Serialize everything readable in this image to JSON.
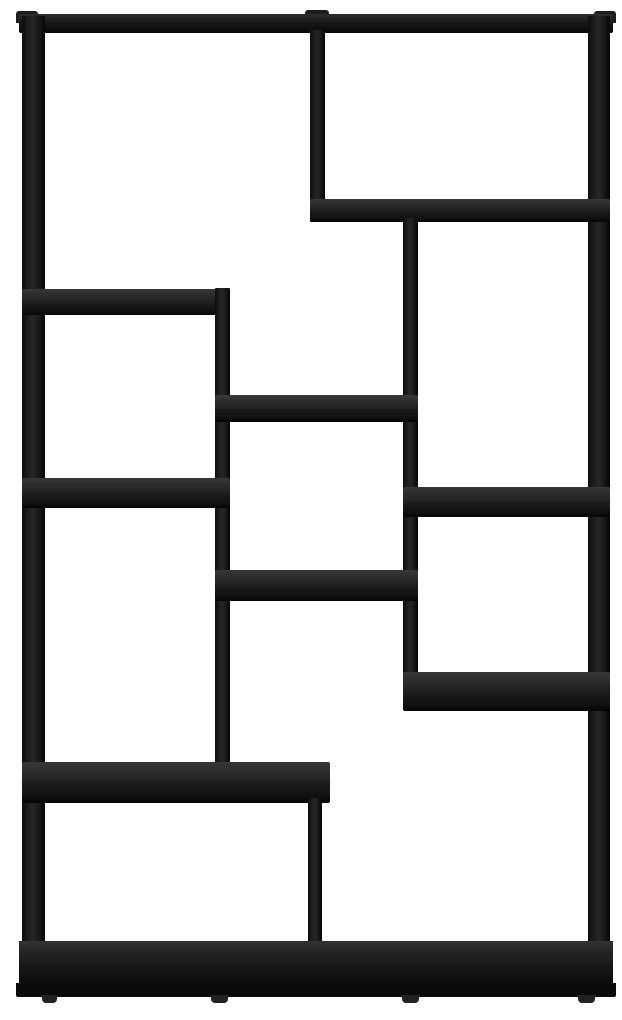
{
  "scene": {
    "description": "product photo of a black asymmetric cube bookshelf on a white background",
    "background_color": "#ffffff",
    "canvas": {
      "width": 622,
      "height": 1020
    },
    "colors": {
      "wood_top_surface": "#2e2e2e",
      "wood_front_face": "#1a1a1a",
      "wood_edge_dark": "#050505",
      "foot": "#222222"
    }
  },
  "members": [
    {
      "name": "top-corner-cap-left",
      "kind": "cap",
      "x": 16,
      "y": 11,
      "w": 22,
      "h": 12
    },
    {
      "name": "top-corner-cap-middle",
      "kind": "cap",
      "x": 305,
      "y": 10,
      "w": 24,
      "h": 12
    },
    {
      "name": "top-corner-cap-right",
      "kind": "cap",
      "x": 594,
      "y": 11,
      "w": 22,
      "h": 12
    },
    {
      "name": "top-frame-bar",
      "kind": "topbar",
      "x": 19,
      "y": 14,
      "w": 594,
      "h": 19
    },
    {
      "name": "left-side-panel",
      "kind": "panel",
      "x": 22,
      "y": 16,
      "w": 23,
      "h": 944
    },
    {
      "name": "right-side-panel",
      "kind": "panel",
      "x": 588,
      "y": 16,
      "w": 22,
      "h": 944
    },
    {
      "name": "divider-top",
      "kind": "panel",
      "x": 310,
      "y": 30,
      "w": 15,
      "h": 192
    },
    {
      "name": "shelf-top-right",
      "kind": "shelf",
      "x": 310,
      "y": 199,
      "w": 300,
      "h": 23
    },
    {
      "name": "divider-upper-middle",
      "kind": "panel",
      "x": 403,
      "y": 218,
      "w": 15,
      "h": 458
    },
    {
      "name": "shelf-upper-left",
      "kind": "shelf",
      "x": 22,
      "y": 289,
      "w": 208,
      "h": 26
    },
    {
      "name": "divider-left-middle",
      "kind": "panel",
      "x": 215,
      "y": 288,
      "w": 15,
      "h": 514
    },
    {
      "name": "shelf-middle-upper",
      "kind": "shelf",
      "x": 215,
      "y": 395,
      "w": 203,
      "h": 27
    },
    {
      "name": "shelf-left-lower",
      "kind": "shelf",
      "x": 22,
      "y": 478,
      "w": 208,
      "h": 30
    },
    {
      "name": "shelf-right-middle",
      "kind": "shelf",
      "x": 403,
      "y": 487,
      "w": 207,
      "h": 30
    },
    {
      "name": "shelf-middle-lower",
      "kind": "shelf",
      "x": 215,
      "y": 570,
      "w": 203,
      "h": 31
    },
    {
      "name": "shelf-right-lower",
      "kind": "shelf",
      "x": 403,
      "y": 672,
      "w": 207,
      "h": 39
    },
    {
      "name": "shelf-bottom-left-wide",
      "kind": "shelf",
      "x": 22,
      "y": 762,
      "w": 308,
      "h": 41
    },
    {
      "name": "divider-bottom",
      "kind": "panel",
      "x": 308,
      "y": 798,
      "w": 14,
      "h": 148
    },
    {
      "name": "bottom-frame-bar",
      "kind": "bottombar",
      "x": 19,
      "y": 941,
      "w": 594,
      "h": 45
    },
    {
      "name": "base-plinth",
      "kind": "base",
      "x": 16,
      "y": 983,
      "w": 600,
      "h": 14
    },
    {
      "name": "foot-left",
      "kind": "foot",
      "x": 42,
      "y": 995,
      "w": 15,
      "h": 8
    },
    {
      "name": "foot-mid-left",
      "kind": "foot",
      "x": 211,
      "y": 995,
      "w": 17,
      "h": 8
    },
    {
      "name": "foot-mid-right",
      "kind": "foot",
      "x": 402,
      "y": 995,
      "w": 17,
      "h": 8
    },
    {
      "name": "foot-right",
      "kind": "foot",
      "x": 578,
      "y": 995,
      "w": 17,
      "h": 8
    }
  ]
}
